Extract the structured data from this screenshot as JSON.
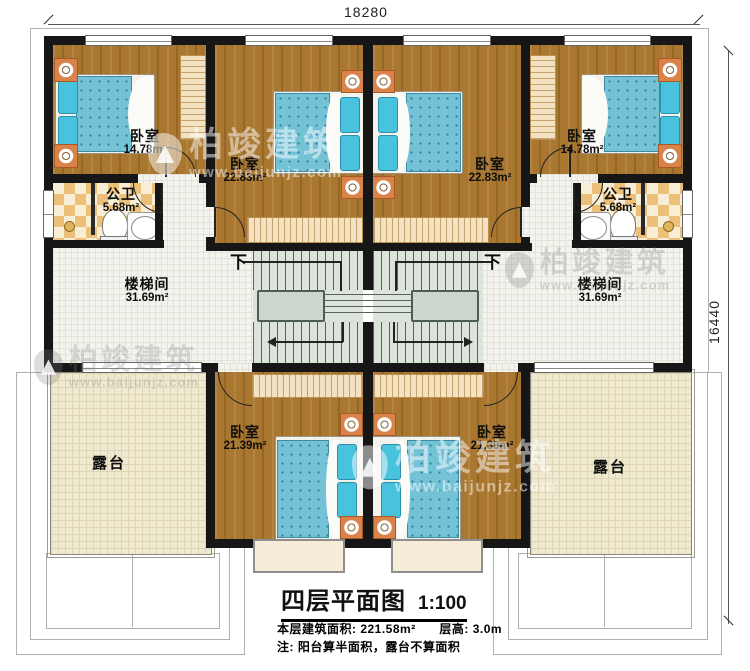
{
  "dimensions": {
    "top": "18280",
    "right": "16440"
  },
  "rooms": {
    "bedroom_tl": {
      "name": "卧室",
      "area": "14.78m²"
    },
    "bedroom_ml": {
      "name": "卧室",
      "area": "22.83m²"
    },
    "bedroom_mr": {
      "name": "卧室",
      "area": "22.83m²"
    },
    "bedroom_tr": {
      "name": "卧室",
      "area": "14.78m²"
    },
    "bath_left": {
      "name": "公卫",
      "area": "5.68m²"
    },
    "bath_right": {
      "name": "公卫",
      "area": "5.68m²"
    },
    "stair_left": {
      "name": "楼梯间",
      "area": "31.69m²"
    },
    "stair_right": {
      "name": "楼梯间",
      "area": "31.69m²"
    },
    "bedroom_bl": {
      "name": "卧室",
      "area": "21.39m²"
    },
    "bedroom_br": {
      "name": "卧室",
      "area": "21.39m²"
    },
    "terrace_left": {
      "name": "露台"
    },
    "terrace_right": {
      "name": "露台"
    }
  },
  "stairs": {
    "down_label": "下"
  },
  "title_block": {
    "title": "四层平面图",
    "scale": "1:100",
    "area_label": "本层建筑面积: 221.58m²",
    "height_label": "层高: 3.0m",
    "note": "注: 阳台算半面积，露台不算面积"
  },
  "watermark": {
    "brand": "柏竣建筑",
    "url": "www.baijunjz.com"
  },
  "colors": {
    "wall": "#161616",
    "wood_floor": "#a9772f",
    "hall_tile": "#f4f3ee",
    "terrace_tile": "#efe9d0",
    "bath_checker": "#ecc078",
    "mattress_blue": "#74c2d6",
    "pillow_cyan": "#49c2de",
    "nightstand_orange": "#d9834a",
    "stair_green": "#dce3da"
  }
}
